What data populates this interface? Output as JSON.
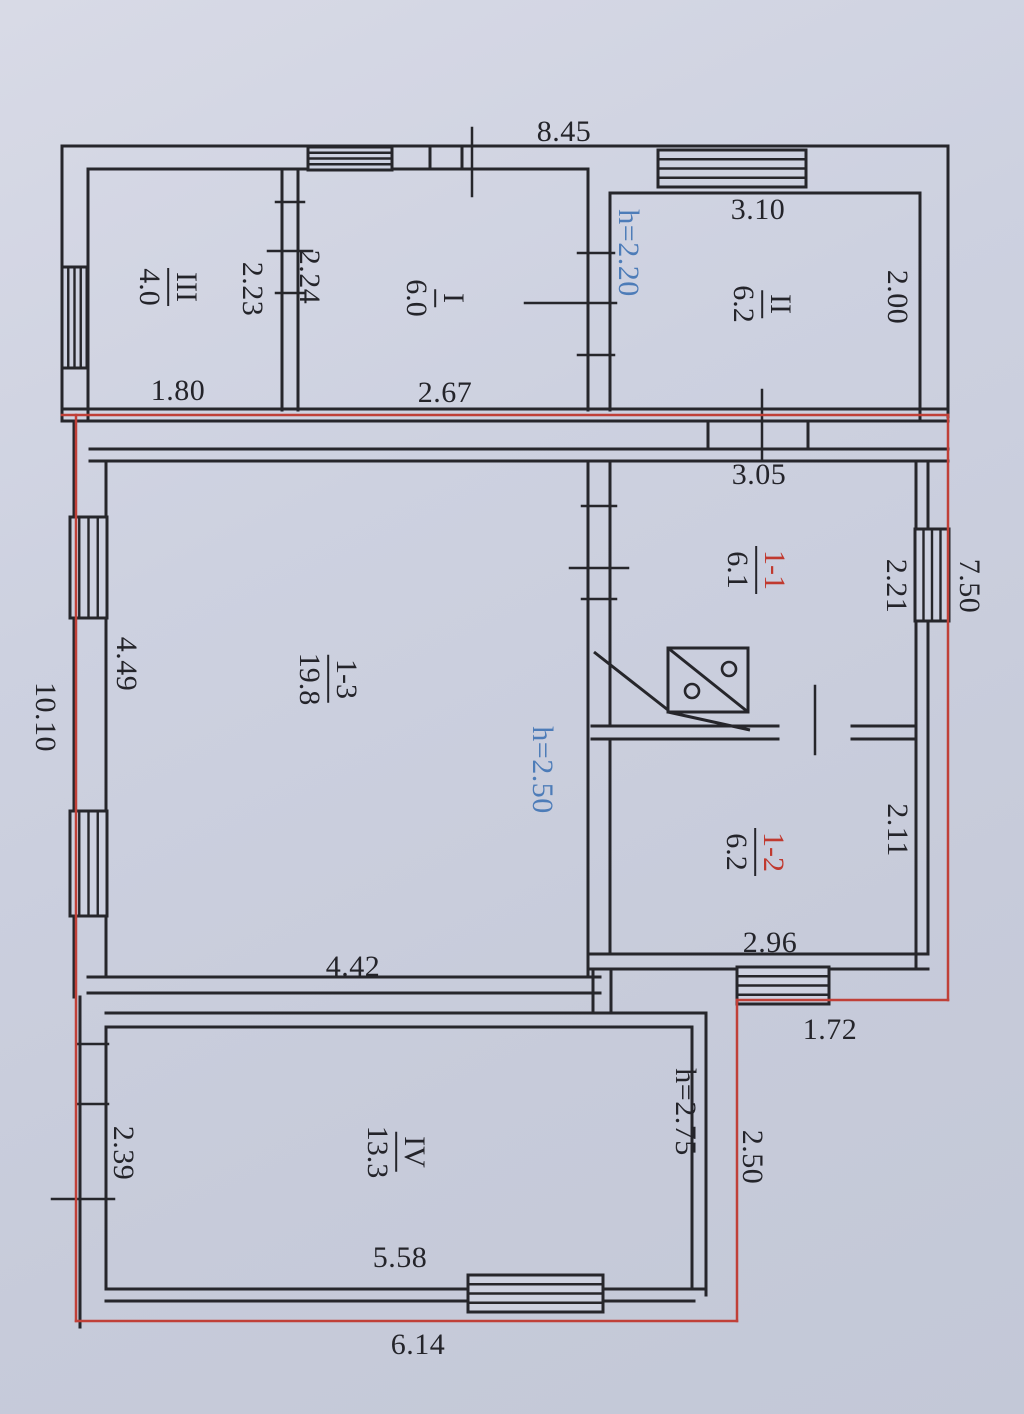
{
  "meta": {
    "canvas": {
      "w": 1024,
      "h": 1414
    },
    "palette": {
      "background": "#cdd1e0",
      "wall": "#26262b",
      "boundary_red": "#c04038",
      "height_blue": "#4d7cb8",
      "label_red": "#c0392f",
      "text": "#24242a"
    }
  },
  "rooms": [
    {
      "number": "III",
      "area": "4.0",
      "x": 168,
      "y": 287,
      "number_color": "black"
    },
    {
      "number": "I",
      "area": "6.0",
      "x": 435,
      "y": 298,
      "number_color": "black"
    },
    {
      "number": "II",
      "area": "6.2",
      "x": 762,
      "y": 304,
      "number_color": "black"
    },
    {
      "number": "1-1",
      "area": "6.1",
      "x": 756,
      "y": 570,
      "number_color": "red"
    },
    {
      "number": "1-3",
      "area": "19.8",
      "x": 328,
      "y": 679,
      "number_color": "black"
    },
    {
      "number": "1-2",
      "area": "6.2",
      "x": 755,
      "y": 852,
      "number_color": "red"
    },
    {
      "number": "IV",
      "area": "13.3",
      "x": 396,
      "y": 1152,
      "number_color": "black"
    }
  ],
  "dimensions": [
    {
      "text": "8.45",
      "x": 564,
      "y": 132,
      "v": false,
      "blue": false
    },
    {
      "text": "3.10",
      "x": 758,
      "y": 210,
      "v": false,
      "blue": false
    },
    {
      "text": "2.00",
      "x": 897,
      "y": 297,
      "v": true,
      "blue": false
    },
    {
      "text": "2.23",
      "x": 252,
      "y": 289,
      "v": true,
      "blue": false
    },
    {
      "text": "2.24",
      "x": 309,
      "y": 277,
      "v": true,
      "blue": false
    },
    {
      "text": "h=2.20",
      "x": 628,
      "y": 253,
      "v": true,
      "blue": true
    },
    {
      "text": "1.80",
      "x": 178,
      "y": 391,
      "v": false,
      "blue": false
    },
    {
      "text": "2.67",
      "x": 445,
      "y": 393,
      "v": false,
      "blue": false
    },
    {
      "text": "3.05",
      "x": 759,
      "y": 475,
      "v": false,
      "blue": false
    },
    {
      "text": "2.21",
      "x": 896,
      "y": 586,
      "v": true,
      "blue": false
    },
    {
      "text": "7.50",
      "x": 969,
      "y": 586,
      "v": true,
      "blue": false
    },
    {
      "text": "4.49",
      "x": 126,
      "y": 664,
      "v": true,
      "blue": false
    },
    {
      "text": "10.10",
      "x": 45,
      "y": 717,
      "v": true,
      "blue": false
    },
    {
      "text": "h=2.50",
      "x": 542,
      "y": 770,
      "v": true,
      "blue": true
    },
    {
      "text": "2.11",
      "x": 897,
      "y": 830,
      "v": true,
      "blue": false
    },
    {
      "text": "4.42",
      "x": 353,
      "y": 967,
      "v": false,
      "blue": false
    },
    {
      "text": "2.96",
      "x": 770,
      "y": 943,
      "v": false,
      "blue": false
    },
    {
      "text": "1.72",
      "x": 830,
      "y": 1030,
      "v": false,
      "blue": false
    },
    {
      "text": "h=2.75",
      "x": 685,
      "y": 1112,
      "v": true,
      "blue": false
    },
    {
      "text": "2.50",
      "x": 752,
      "y": 1157,
      "v": true,
      "blue": false
    },
    {
      "text": "2.39",
      "x": 123,
      "y": 1153,
      "v": true,
      "blue": false
    },
    {
      "text": "5.58",
      "x": 400,
      "y": 1258,
      "v": false,
      "blue": false
    },
    {
      "text": "6.14",
      "x": 418,
      "y": 1345,
      "v": false,
      "blue": false
    }
  ],
  "geometry": {
    "wall_lines": [
      [
        62,
        146,
        948,
        146
      ],
      [
        62,
        146,
        62,
        421
      ],
      [
        948,
        146,
        948,
        417
      ],
      [
        88,
        169,
        588,
        169
      ],
      [
        612,
        193,
        920,
        193
      ],
      [
        88,
        169,
        88,
        421
      ],
      [
        282,
        169,
        282,
        410
      ],
      [
        298,
        169,
        298,
        410
      ],
      [
        588,
        169,
        588,
        410
      ],
      [
        610,
        193,
        610,
        410
      ],
      [
        920,
        193,
        920,
        421
      ],
      [
        430,
        148,
        430,
        169
      ],
      [
        462,
        148,
        462,
        169
      ],
      [
        62,
        409,
        948,
        409
      ],
      [
        62,
        421,
        948,
        421
      ],
      [
        90,
        449,
        948,
        449
      ],
      [
        90,
        461,
        948,
        461
      ],
      [
        708,
        421,
        708,
        449
      ],
      [
        808,
        421,
        808,
        449
      ],
      [
        74,
        421,
        74,
        997
      ],
      [
        106,
        461,
        106,
        977
      ],
      [
        588,
        461,
        588,
        977
      ],
      [
        610,
        461,
        610,
        726
      ],
      [
        610,
        740,
        610,
        954
      ],
      [
        916,
        461,
        916,
        969
      ],
      [
        928,
        461,
        928,
        954
      ],
      [
        592,
        726,
        778,
        726
      ],
      [
        852,
        726,
        916,
        726
      ],
      [
        592,
        739,
        778,
        739
      ],
      [
        852,
        739,
        916,
        739
      ],
      [
        588,
        954,
        928,
        954
      ],
      [
        588,
        969,
        928,
        969
      ],
      [
        88,
        977,
        600,
        977
      ],
      [
        88,
        993,
        600,
        993
      ],
      [
        593,
        969,
        593,
        1013
      ],
      [
        611,
        969,
        611,
        1013
      ],
      [
        106,
        1013,
        706,
        1013
      ],
      [
        106,
        1027,
        692,
        1027
      ],
      [
        80,
        997,
        80,
        1327
      ],
      [
        106,
        1027,
        106,
        1289
      ],
      [
        706,
        1013,
        706,
        1295
      ],
      [
        692,
        1027,
        692,
        1289
      ],
      [
        106,
        1289,
        706,
        1289
      ],
      [
        106,
        1301,
        694,
        1301
      ]
    ],
    "ticks": [
      [
        472,
        128,
        472,
        196
      ],
      [
        762,
        390,
        762,
        461
      ],
      [
        525,
        303,
        616,
        303
      ],
      [
        578,
        253,
        614,
        253
      ],
      [
        578,
        355,
        614,
        355
      ],
      [
        268,
        251,
        312,
        251
      ],
      [
        276,
        202,
        304,
        202
      ],
      [
        276,
        293,
        304,
        293
      ],
      [
        582,
        506,
        616,
        506
      ],
      [
        582,
        599,
        616,
        599
      ],
      [
        570,
        568,
        628,
        568
      ],
      [
        815,
        686,
        815,
        754
      ],
      [
        78,
        1044,
        108,
        1044
      ],
      [
        78,
        1104,
        108,
        1104
      ],
      [
        52,
        1199,
        114,
        1199
      ]
    ],
    "windows": [
      {
        "x": 308,
        "y": 147,
        "w": 84,
        "h": 23,
        "dir": "h",
        "n": 3
      },
      {
        "x": 658,
        "y": 150,
        "w": 148,
        "h": 37,
        "dir": "h",
        "n": 3
      },
      {
        "x": 62,
        "y": 267,
        "w": 25,
        "h": 101,
        "dir": "v",
        "n": 3
      },
      {
        "x": 70,
        "y": 517,
        "w": 37,
        "h": 101,
        "dir": "v",
        "n": 3
      },
      {
        "x": 70,
        "y": 811,
        "w": 37,
        "h": 105,
        "dir": "v",
        "n": 3
      },
      {
        "x": 915,
        "y": 529,
        "w": 34,
        "h": 92,
        "dir": "v",
        "n": 3
      },
      {
        "x": 737,
        "y": 967,
        "w": 92,
        "h": 37,
        "dir": "h",
        "n": 3
      },
      {
        "x": 468,
        "y": 1275,
        "w": 135,
        "h": 37,
        "dir": "h",
        "n": 3
      }
    ],
    "red_lines": [
      [
        62,
        415,
        948,
        415
      ],
      [
        76,
        415,
        76,
        1321
      ],
      [
        948,
        415,
        948,
        1000
      ],
      [
        737,
        1000,
        948,
        1000
      ],
      [
        737,
        1000,
        737,
        1321
      ],
      [
        76,
        1321,
        737,
        1321
      ]
    ],
    "stove": {
      "rect": [
        668,
        648,
        80,
        64
      ],
      "lines": [
        [
          594,
          652,
          668,
          710
        ],
        [
          668,
          648,
          748,
          712
        ],
        [
          668,
          712,
          750,
          730
        ]
      ],
      "circles": [
        [
          692,
          691,
          7
        ],
        [
          729,
          669,
          7
        ]
      ]
    }
  }
}
